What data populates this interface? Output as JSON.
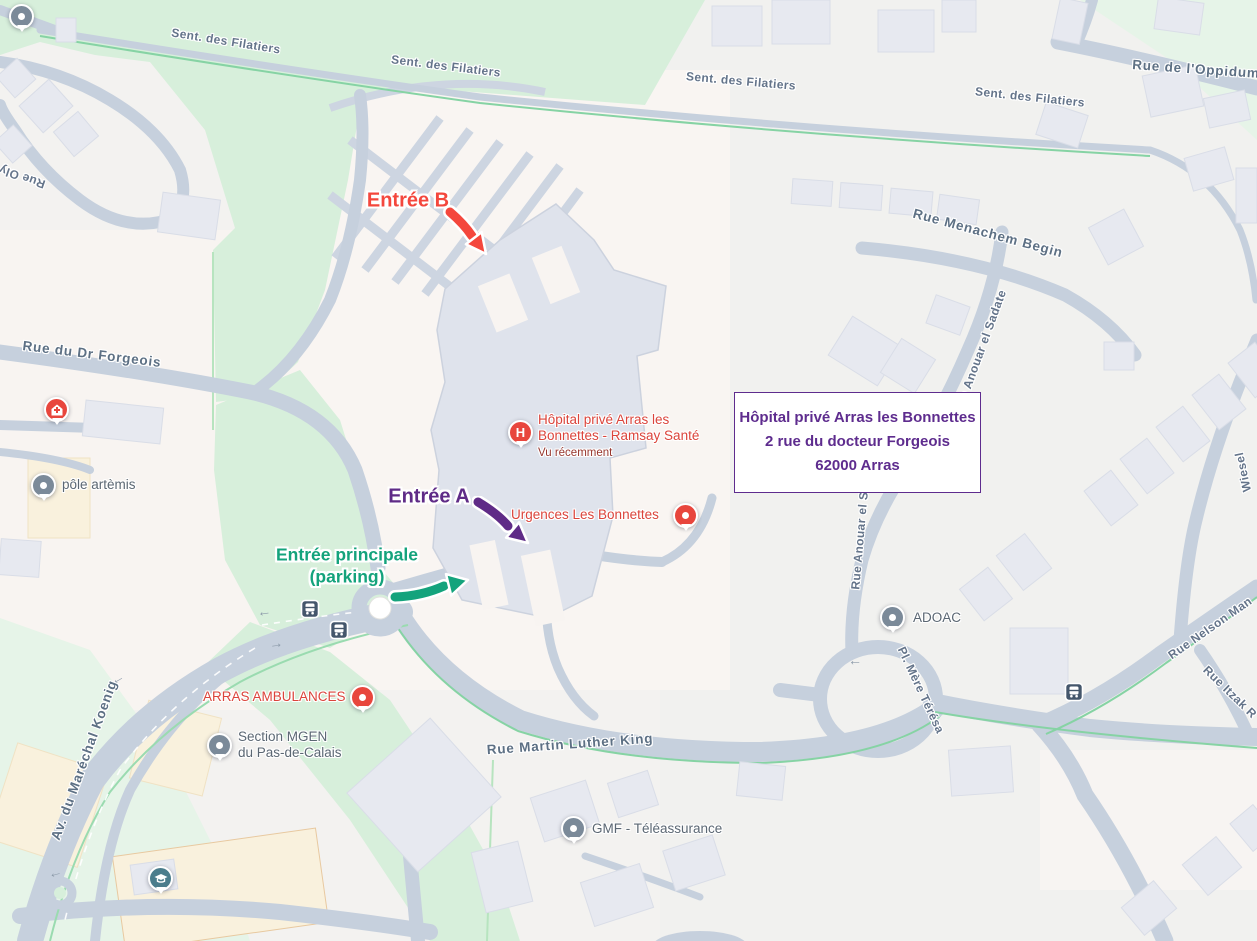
{
  "annotations": {
    "entree_b": {
      "label": "Entrée B",
      "color": "#f4473d"
    },
    "entree_a": {
      "label": "Entrée A",
      "color": "#5f2b87"
    },
    "entree_principale": {
      "line1": "Entrée principale",
      "line2": "(parking)",
      "color": "#14a37c"
    }
  },
  "info_box": {
    "line1": "Hôpital privé Arras les Bonnettes",
    "line2": "2 rue du docteur Forgeois",
    "line3": "62000 Arras",
    "accent_color": "#5e2c8e"
  },
  "pois": {
    "hospital": {
      "name": "Hôpital privé Arras les Bonnettes - Ramsay Santé",
      "status": "Vu récemment",
      "marker_letter": "H"
    },
    "urgences": {
      "name": "Urgences Les Bonnettes"
    },
    "pole_artemis": {
      "name": "pôle artèmis"
    },
    "arras_ambulances": {
      "name": "ARRAS AMBULANCES"
    },
    "mgen": {
      "line1": "Section MGEN",
      "line2": "du Pas-de-Calais"
    },
    "gmf": {
      "name": "GMF - Téléassurance"
    },
    "adoac": {
      "name": "ADOAC"
    }
  },
  "streets": {
    "filatiers": "Sent. des Filatiers",
    "oppidum": "Rue de l'Oppidum",
    "menachem_begin": "Rue Menachem Begin",
    "anouar_el_sadate": "Rue Anouar el Sadate",
    "dr_forgeois": "Rue du Dr Forgeois",
    "marechal_koenig": "Av. du Maréchal Koenig",
    "martin_luther_king": "Rue Martin Luther King",
    "mere_teresa": "Pl. Mère Térésa",
    "nelson_mandela": "Rue Nelson Man",
    "itzak_rabin": "Rue Itzak R",
    "wiesel": "Wiesel",
    "oly": "Rue Oly"
  },
  "icons": {
    "arrow_left": "←",
    "arrow_right": "→"
  },
  "map_colors": {
    "road": "#c6d0dd",
    "park_green": "#d7efdb",
    "pale_green": "#e6f4e8",
    "building": "#e7e9f0",
    "hospital_building": "#dfe3ec",
    "poi_red": "#db443b",
    "bus_icon": "#44566b"
  }
}
